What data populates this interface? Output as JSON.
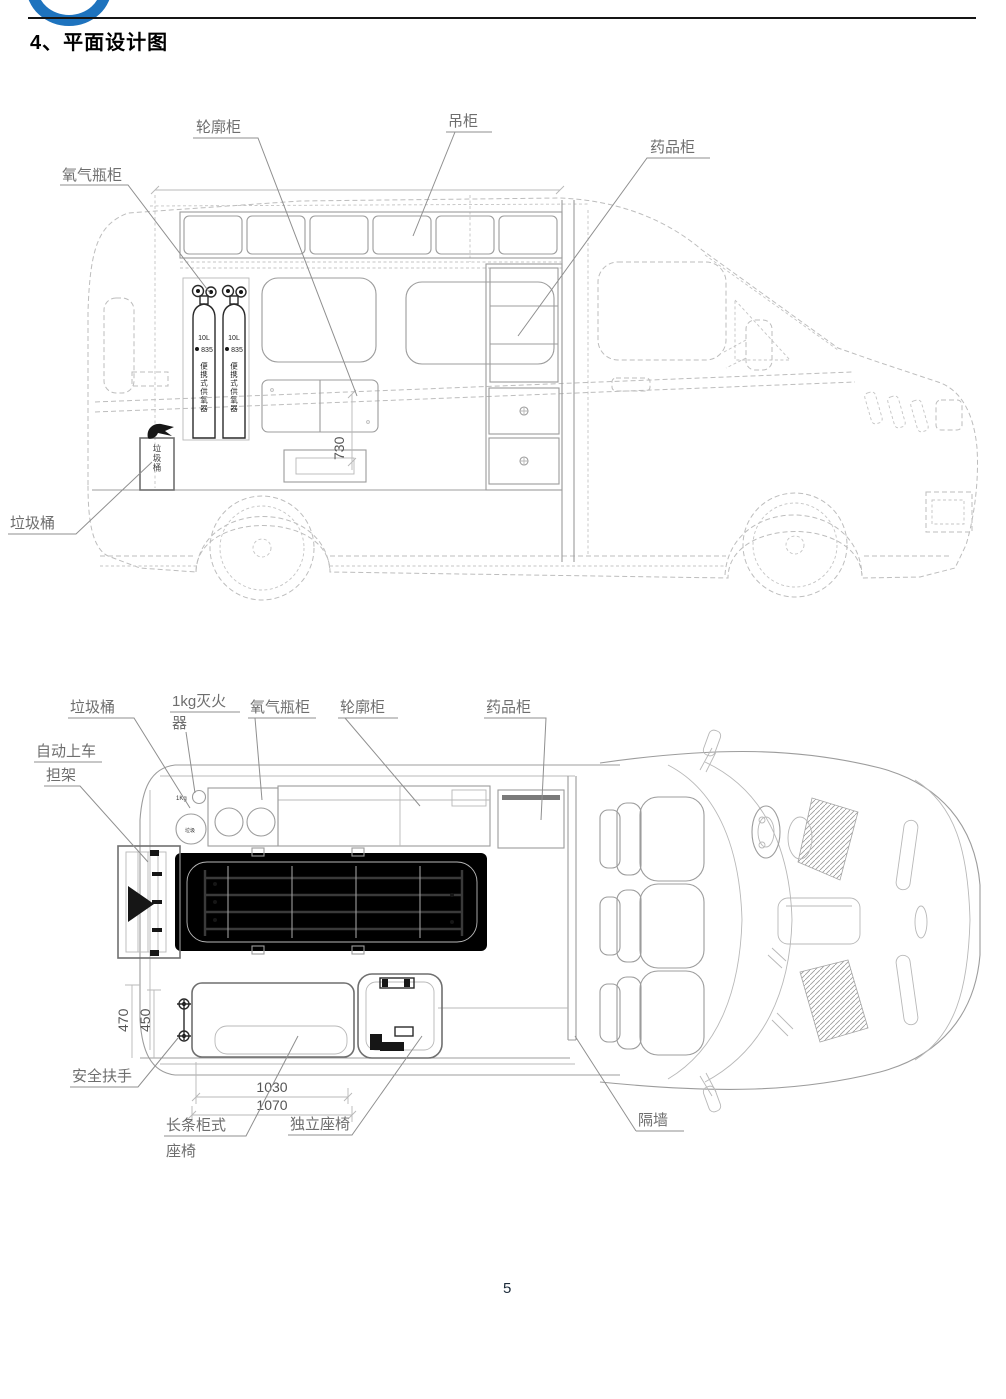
{
  "page": {
    "title": "4、平面设计图",
    "page_number": "5"
  },
  "colors": {
    "logo_blue": "#1e73be",
    "drawing_line": "#b0b0b0",
    "label_text": "#6e6e6e",
    "dark_detail": "#1f1f1f"
  },
  "side_view": {
    "labels": {
      "oxygen_cabinet": "氧气瓶柜",
      "wheel_cabinet": "轮廓柜",
      "hanging_cabinet": "吊柜",
      "medicine_cabinet": "药品柜",
      "trash_bin": "垃圾桶"
    },
    "cylinder": {
      "capacity": "10L",
      "model": "835",
      "side_text": "便携式供氧器"
    },
    "trash_bin_text": "垃圾桶",
    "dim_730": "730"
  },
  "top_view": {
    "labels": {
      "trash_bin": "垃圾桶",
      "fire_extinguisher_1": "1kg灭火",
      "fire_extinguisher_2": "器",
      "oxygen_cabinet": "氧气瓶柜",
      "wheel_cabinet": "轮廓柜",
      "medicine_cabinet": "药品柜",
      "stretcher_1": "自动上车",
      "stretcher_2": "担架",
      "handrail": "安全扶手",
      "bench_seat_1": "长条柜式",
      "bench_seat_2": "座椅",
      "single_seat": "独立座椅",
      "partition": "隔墙"
    },
    "marks": {
      "extinguisher": "1Kg",
      "trash": "垃圾"
    },
    "dims": {
      "h470": "470",
      "h450": "450",
      "w1030": "1030",
      "w1070": "1070"
    }
  }
}
